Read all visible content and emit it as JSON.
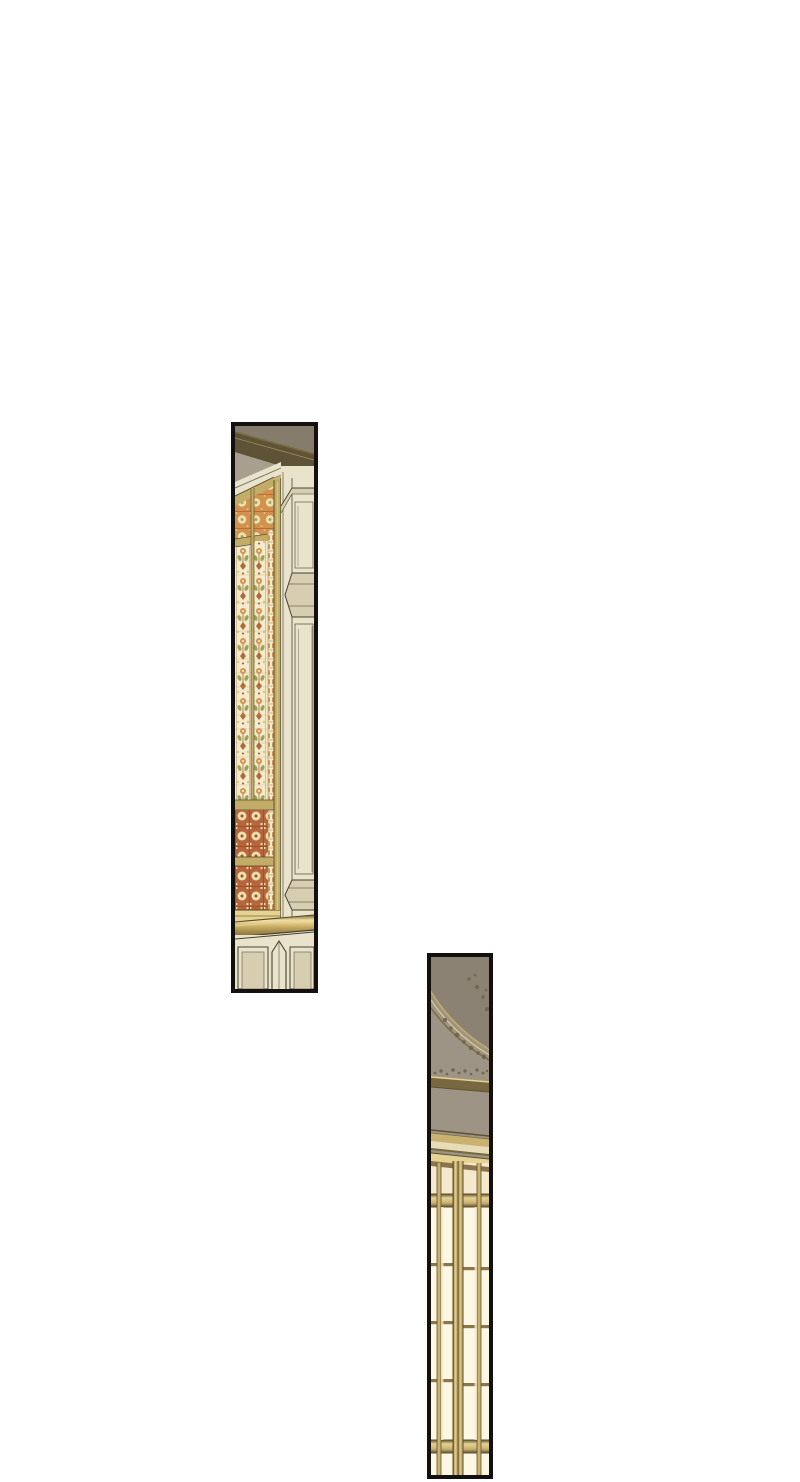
{
  "page": {
    "background": "#ffffff",
    "width": 800,
    "height": 1482
  },
  "panels": [
    {
      "name": "stained-glass-wall-panel",
      "alt": "Tall narrow panel showing an ornate stained-glass window strip beside cream wood wall paneling, dark cornice above, brass rail and wainscot below",
      "geom": {
        "left": 231,
        "top": 422,
        "width": 87,
        "height": 571
      },
      "border_color": "#121110"
    },
    {
      "name": "lattice-window-panel",
      "alt": "Tall narrow panel showing a taupe ceiling with a gold arc molding and foliage, a striped cornice, and a glowing gold lattice window",
      "geom": {
        "left": 427,
        "top": 953,
        "width": 66,
        "height": 526
      },
      "border_color": "#121110"
    }
  ],
  "palette": {
    "page-bg": "#ffffff",
    "ink": "#121110",
    "p1-taupe": "#98907f",
    "p1-taupe-dark": "#857c6c",
    "p1-taupe-light": "#a89f8e",
    "p1-cornice": "#5e5336",
    "p1-cream": "#eae3cc",
    "p1-cream-shade": "#d7ceb1",
    "p1-line": "#6e6753",
    "p1-dark-line": "#45402f",
    "gold": "#c3ac68",
    "gold-dark": "#7b6a3e",
    "gold-deep": "#574a28",
    "gold-bright": "#e6d292",
    "glass-base": "#f4eacc",
    "glass-orange": "#d2924e",
    "glass-deep": "#b06a38",
    "glass-red": "#a2512d",
    "glass-green": "#9aa351",
    "glass-yellow": "#d8c87c",
    "glass-lead": "#bb9d6e",
    "rose-bg": "#b5663c",
    "rose-cream": "#eddfb0",
    "brass-hi": "#f2e2a6",
    "brass": "#c6aa60",
    "brass-sh": "#7d6737",
    "p2-ceil": "#8b8273",
    "p2-ceil-light": "#9d9485",
    "p2-fleck": "#6c6347",
    "p2-cornice-cream": "#e8dcb7",
    "p2-olive": "#77683f",
    "pane": "#fdf8e4",
    "pane-amber": "#f5e9cd",
    "mullion": "#c9b170",
    "mullion-dark": "#8a764a",
    "mullion-edge": "#5f5130"
  }
}
